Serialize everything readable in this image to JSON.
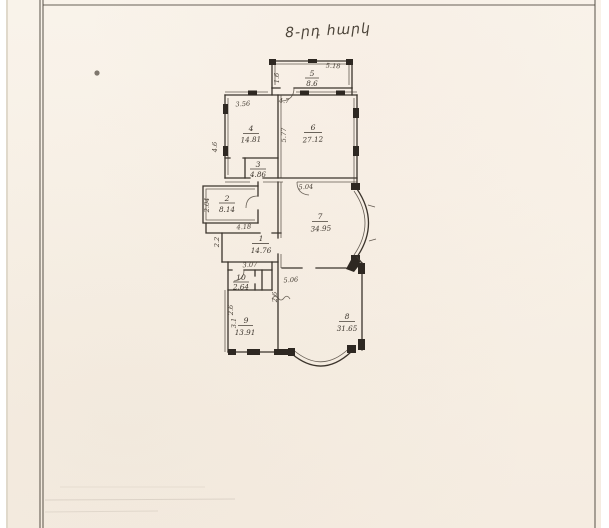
{
  "document": {
    "type": "scanned floor plan sheet",
    "title_handwritten": "8-րդ հարկ"
  },
  "plan": {
    "rooms": {
      "r1": {
        "num": "1",
        "area": "14.76"
      },
      "r2": {
        "num": "2",
        "area": "8.14"
      },
      "r3": {
        "num": "3",
        "area": "4.86"
      },
      "r4": {
        "num": "4",
        "area": "14.81"
      },
      "r5": {
        "num": "5",
        "area": "8.6"
      },
      "r6": {
        "num": "6",
        "area": "27.12"
      },
      "r7": {
        "num": "7",
        "area": "34.95"
      },
      "r8": {
        "num": "8",
        "area": "31.65"
      },
      "r9": {
        "num": "9",
        "area": "13.91"
      },
      "r10": {
        "num": "10",
        "area": "2.64"
      }
    },
    "dims": {
      "d518": "5.18",
      "d16": "1.6",
      "d47": "4.7",
      "d356": "3.56",
      "d46": "4.6",
      "d577": "5.77",
      "d504": "5.04",
      "d204": "2.04",
      "d418": "4.18",
      "d22": "2.2",
      "d307": "3.07",
      "d506": "5.06",
      "d26a": "2.6",
      "d26b": "2.6",
      "d31": "3.1"
    }
  },
  "colors": {
    "paper": "#f8f1e7",
    "ink": "#3b342c",
    "frame_line": "#4e473e",
    "background": "#ffffff"
  }
}
